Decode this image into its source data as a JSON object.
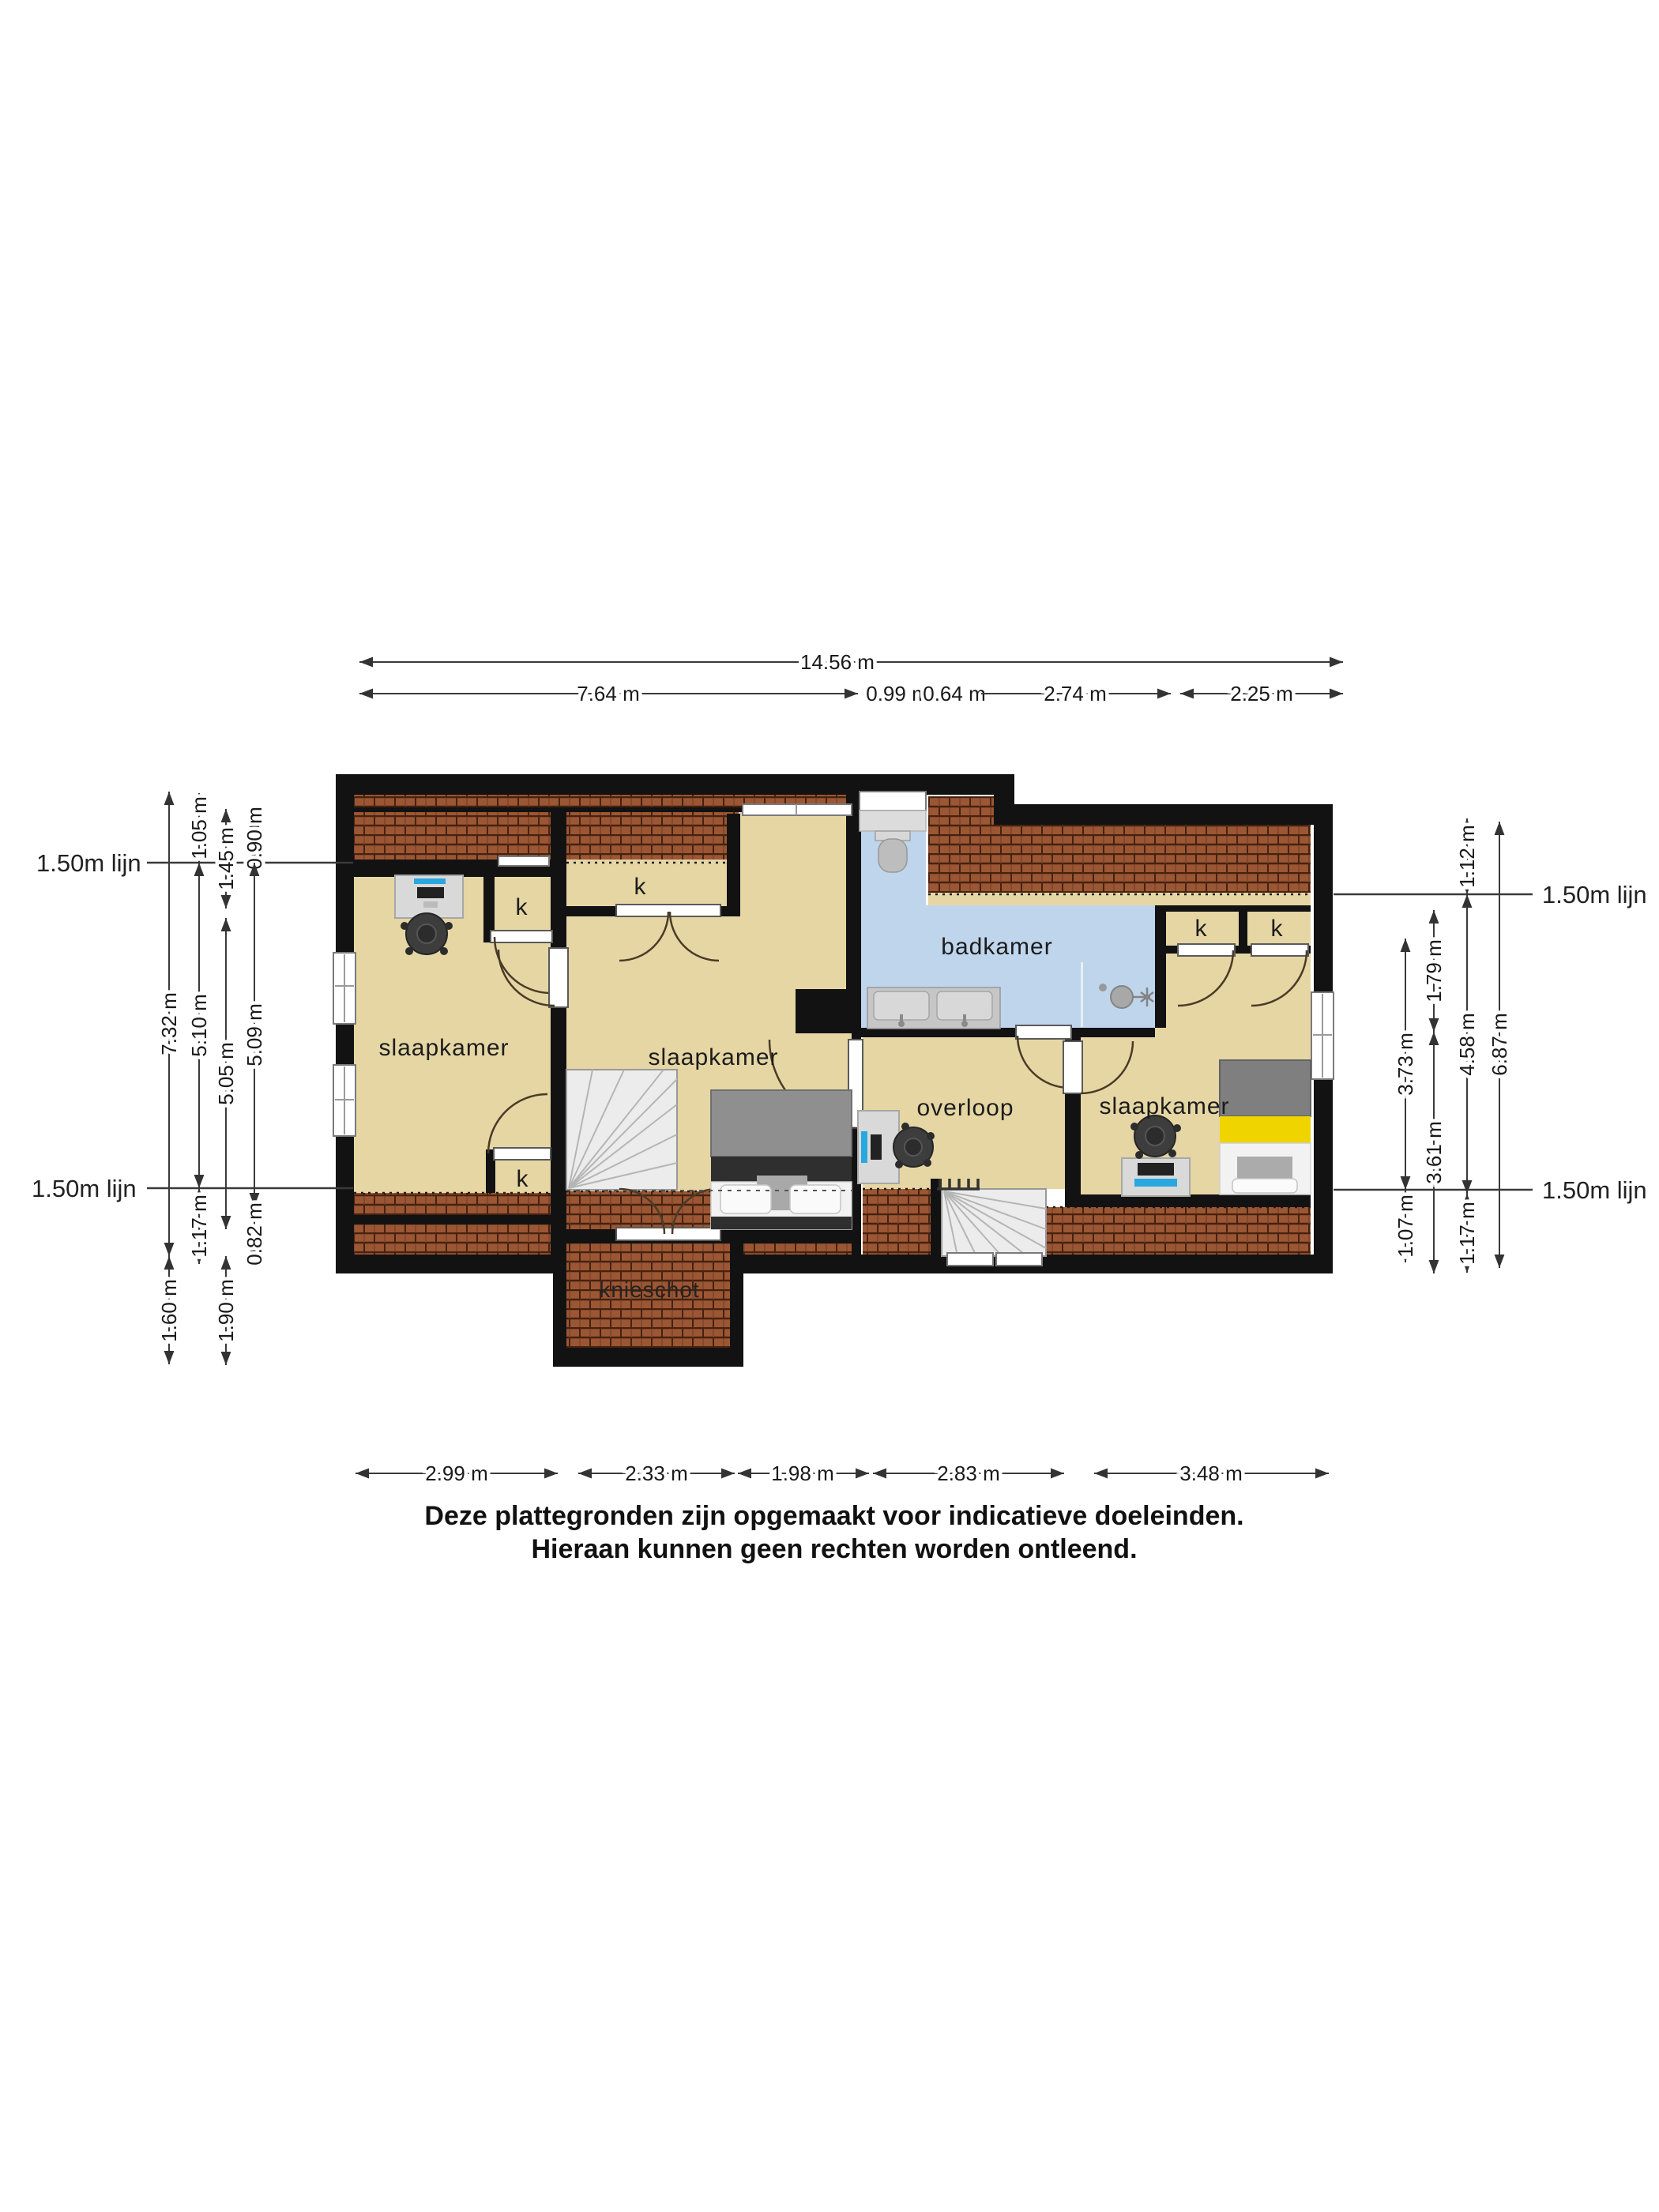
{
  "rooms": {
    "bedroom_left": "slaapkamer",
    "bedroom_middle": "slaapkamer",
    "bedroom_right": "slaapkamer",
    "bathroom": "badkamer",
    "landing": "overloop",
    "knee_wall": "knieschot",
    "closet": "k"
  },
  "reference_lines": {
    "label": "1.50m lijn"
  },
  "dimensions": {
    "top_total": "14.56 m",
    "top": [
      "7.64 m",
      "0.99 m",
      "0.64 m",
      "2.74 m",
      "2.25 m"
    ],
    "left_col1": [
      "7.32 m",
      "1.60 m"
    ],
    "left_col2": [
      "1.05 m",
      "5.10 m",
      "1.17 m"
    ],
    "left_col3": [
      "1.45 m",
      "5.05 m",
      "1.90 m"
    ],
    "left_col4": [
      "0.90 m",
      "5.09 m",
      "0.82 m"
    ],
    "right_col1": [
      "3.73 m",
      "1.07 m"
    ],
    "right_col2": [
      "1.79 m",
      "3.61 m"
    ],
    "right_col3": [
      "1.12 m",
      "4.58 m",
      "1.17 m"
    ],
    "right_col4": [
      "6.87 m"
    ],
    "bottom": [
      "2.99 m",
      "2.33 m",
      "1.98 m",
      "2.83 m",
      "3.48 m"
    ]
  },
  "disclaimer": [
    "Deze plattegronden zijn opgemaakt voor indicatieve doeleinden.",
    "Hieraan kunnen geen rechten worden ontleend."
  ],
  "colors": {
    "floor": "#e5d6a4",
    "bathroom_floor": "#bed5ec",
    "roof_tile": "#9b5634",
    "roof_tile_line": "#45220f",
    "wall": "#121212",
    "bed_yellow": "#efd400",
    "monitor_blue": "#29a8df"
  }
}
